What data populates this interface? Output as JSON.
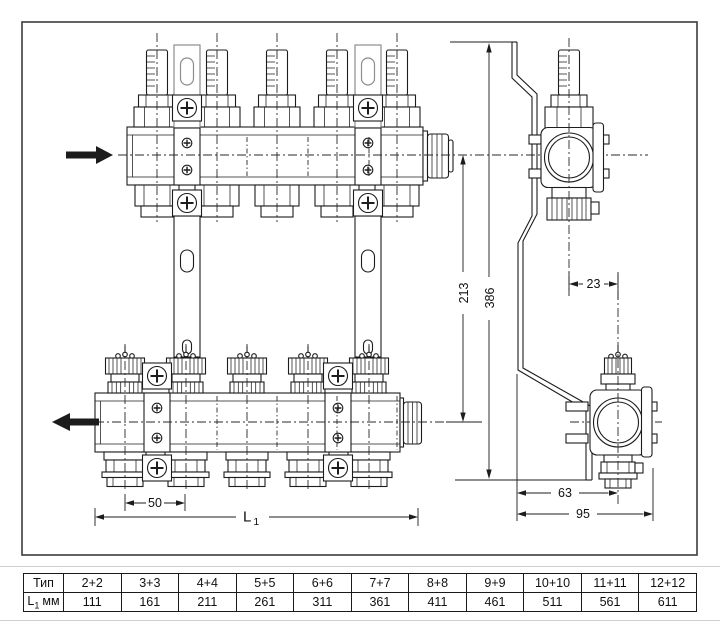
{
  "dims": {
    "outlet_spacing": "50",
    "length_main": "L",
    "length_sub": "1",
    "center_distance": "213",
    "total_height": "386",
    "axis_offset": "23",
    "bracket_to_axis": "63",
    "total_depth": "95"
  },
  "table": {
    "type_label": "Тип",
    "length_label_main": "L",
    "length_label_sub": "1",
    "length_label_unit": "мм",
    "columns": [
      {
        "type": "2+2",
        "l1": "111"
      },
      {
        "type": "3+3",
        "l1": "161"
      },
      {
        "type": "4+4",
        "l1": "211"
      },
      {
        "type": "5+5",
        "l1": "261"
      },
      {
        "type": "6+6",
        "l1": "311"
      },
      {
        "type": "7+7",
        "l1": "361"
      },
      {
        "type": "8+8",
        "l1": "411"
      },
      {
        "type": "9+9",
        "l1": "461"
      },
      {
        "type": "10+10",
        "l1": "511"
      },
      {
        "type": "11+11",
        "l1": "561"
      },
      {
        "type": "12+12",
        "l1": "611"
      }
    ]
  },
  "colors": {
    "line": "#1c1c1c",
    "gray_line": "#8d8d8d",
    "frame": "#3c3c3c",
    "separator": "#cfcfcf",
    "background": "#ffffff"
  }
}
